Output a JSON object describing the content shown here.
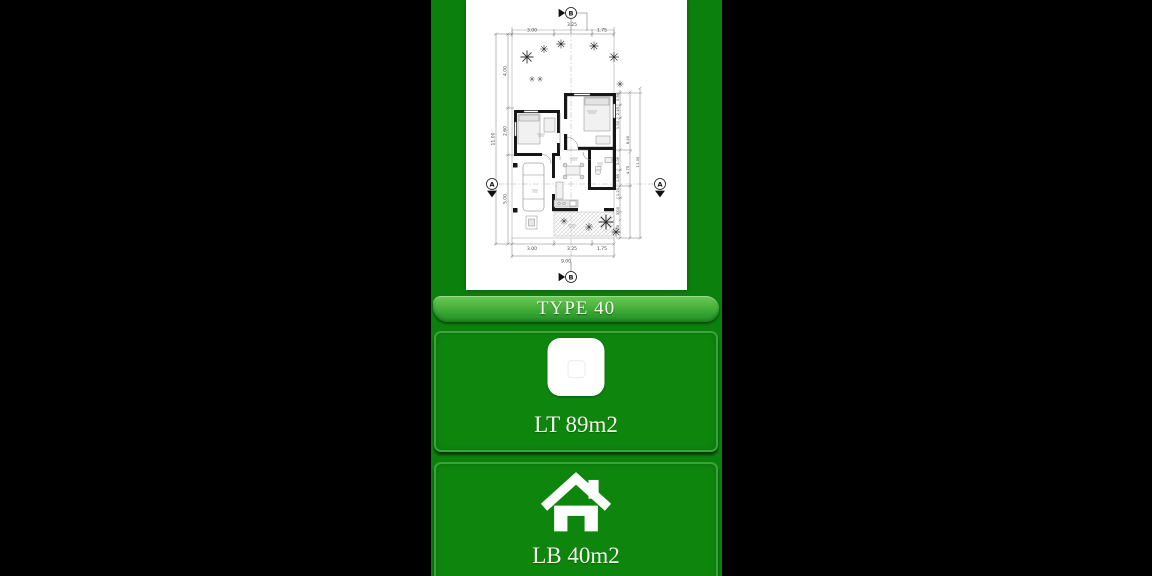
{
  "colors": {
    "background": "#000000",
    "panel_green": "#0c800c",
    "card_green": "#0e860e",
    "card_border": "#3aa33a",
    "banner_green_top": "#6cca57",
    "banner_green_bottom": "#2f9e2f",
    "text": "#f7f7ee"
  },
  "banner": {
    "label": "TYPE 40"
  },
  "cards": [
    {
      "id": "land-area",
      "icon": "square-icon",
      "label": "LT 89m2"
    },
    {
      "id": "building-area",
      "icon": "house-icon",
      "label": "LB 40m2"
    }
  ],
  "floorplan": {
    "marker_a": "A",
    "marker_b": "B",
    "dims_top": [
      "3.00",
      "3.25",
      "1.75"
    ],
    "dims_left": [
      "4.00",
      "2.60",
      "5.00"
    ],
    "dim_left_total": "11.00",
    "dims_bottom": [
      "3.00",
      "3.25",
      "1.75"
    ],
    "dim_bottom_total": "9.00",
    "dims_right": [
      "0.95",
      "2.45",
      "1.50",
      "3.05",
      "1.85",
      "1.20",
      "3.00",
      "1.80"
    ],
    "dims_right_outer": [
      "8.40",
      "4.75",
      "11.00"
    ]
  }
}
